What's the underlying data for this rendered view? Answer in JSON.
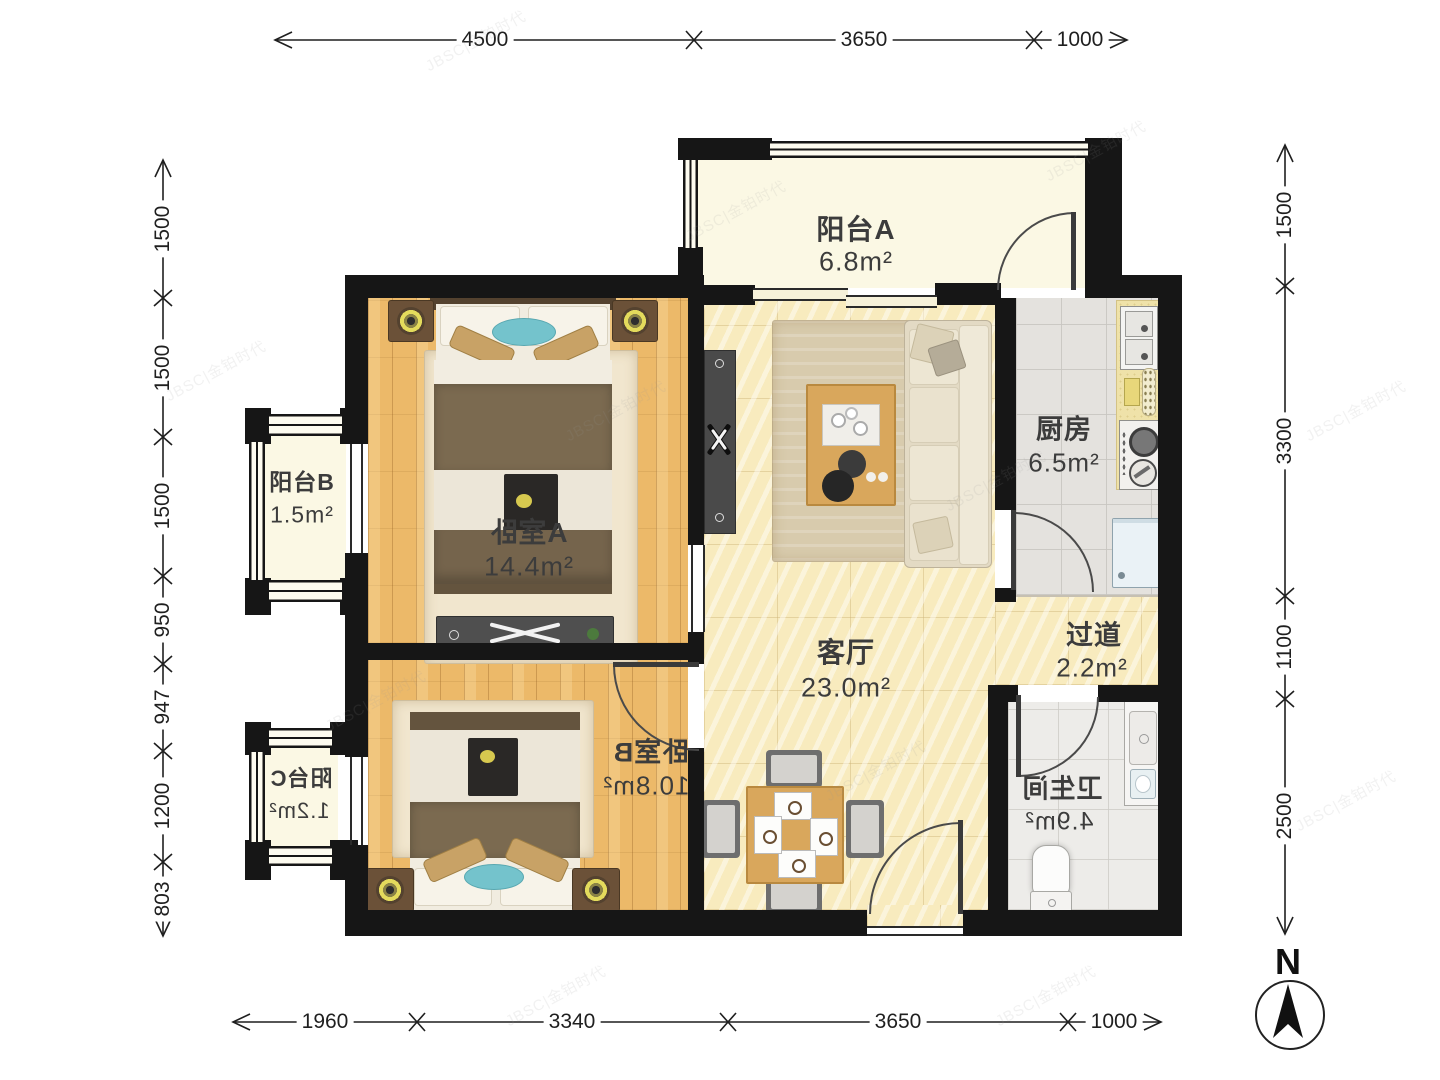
{
  "title": "apartment-floor-plan",
  "rooms": {
    "balcony_a": {
      "name": "阳台A",
      "area": "6.8m²"
    },
    "kitchen": {
      "name": "厨房",
      "area": "6.5m²"
    },
    "balcony_b": {
      "name": "阳台B",
      "area": "1.5m²"
    },
    "bedroom_a": {
      "name_flip": "卧",
      "name_rest": "室A",
      "area": "14.4m²"
    },
    "living": {
      "name": "客厅",
      "area": "23.0m²"
    },
    "hallway": {
      "name": "过道",
      "area": "2.2m²"
    },
    "bedroom_b": {
      "name": "卧室B",
      "area": "10.8m²",
      "mirrored": true
    },
    "balcony_c": {
      "name": "阳台C",
      "area": "1.2m²",
      "mirrored": true
    },
    "bathroom": {
      "name": "卫生间",
      "area": "4.9m²",
      "mirrored": true
    }
  },
  "dimensions": {
    "top": [
      "4500",
      "3650",
      "1000"
    ],
    "bottom": [
      "1960",
      "3340",
      "3650",
      "1000"
    ],
    "left": [
      "1500",
      "1500",
      "1500",
      "950",
      "947",
      "1200",
      "803"
    ],
    "right": [
      "1500",
      "3300",
      "1100",
      "2500"
    ]
  },
  "compass": {
    "label": "N"
  },
  "watermark": {
    "text": "JBSC|金铂时代"
  },
  "colors": {
    "wall": "#161616",
    "wood_floor": "#ECB969",
    "marble_floor": "#F8EBBE",
    "tile_floor": "#E4E2DE",
    "balcony_floor": "#FBF8E4",
    "label_text": "#3C3C3C"
  }
}
